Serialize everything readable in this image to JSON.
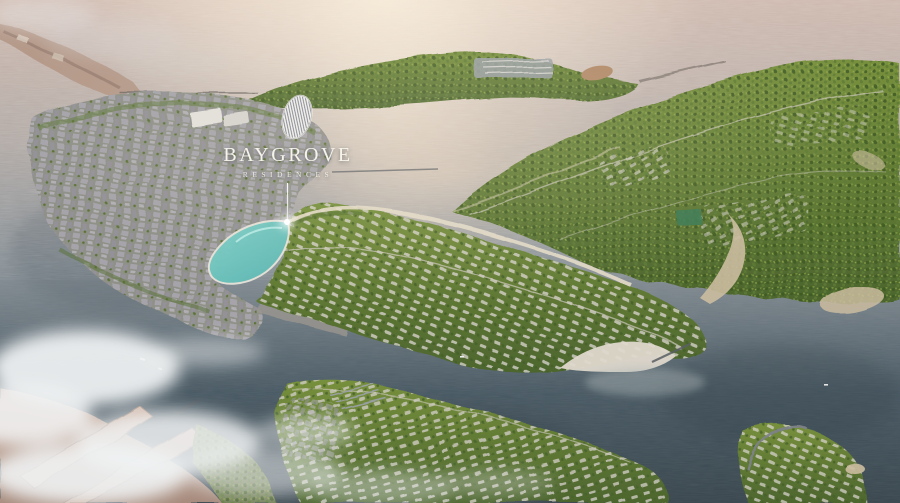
{
  "label": {
    "title": "BAYGROVE",
    "subtitle": "RESIDENCES"
  },
  "palette": {
    "sun_glare": "#f8ecda",
    "water_far": "#cfbab0",
    "water_warm": "#b3aba7",
    "water_mid": "#8a9298",
    "water_deep": "#4a5a64",
    "water_dark": "#3a474f",
    "lagoon_teal": "#7fd2ca",
    "land_green": "#6d8438",
    "land_green_dark": "#4e672f",
    "land_green_light": "#98a648",
    "city_gray": "#9c98a0",
    "roof_light": "#d9d5d0",
    "sand": "#cbbca0",
    "beach_pale": "#ded8cc",
    "shore_tan": "#c2a08f",
    "cloud_white": "#f1f3f4",
    "label_white": "#f6f3eb"
  }
}
